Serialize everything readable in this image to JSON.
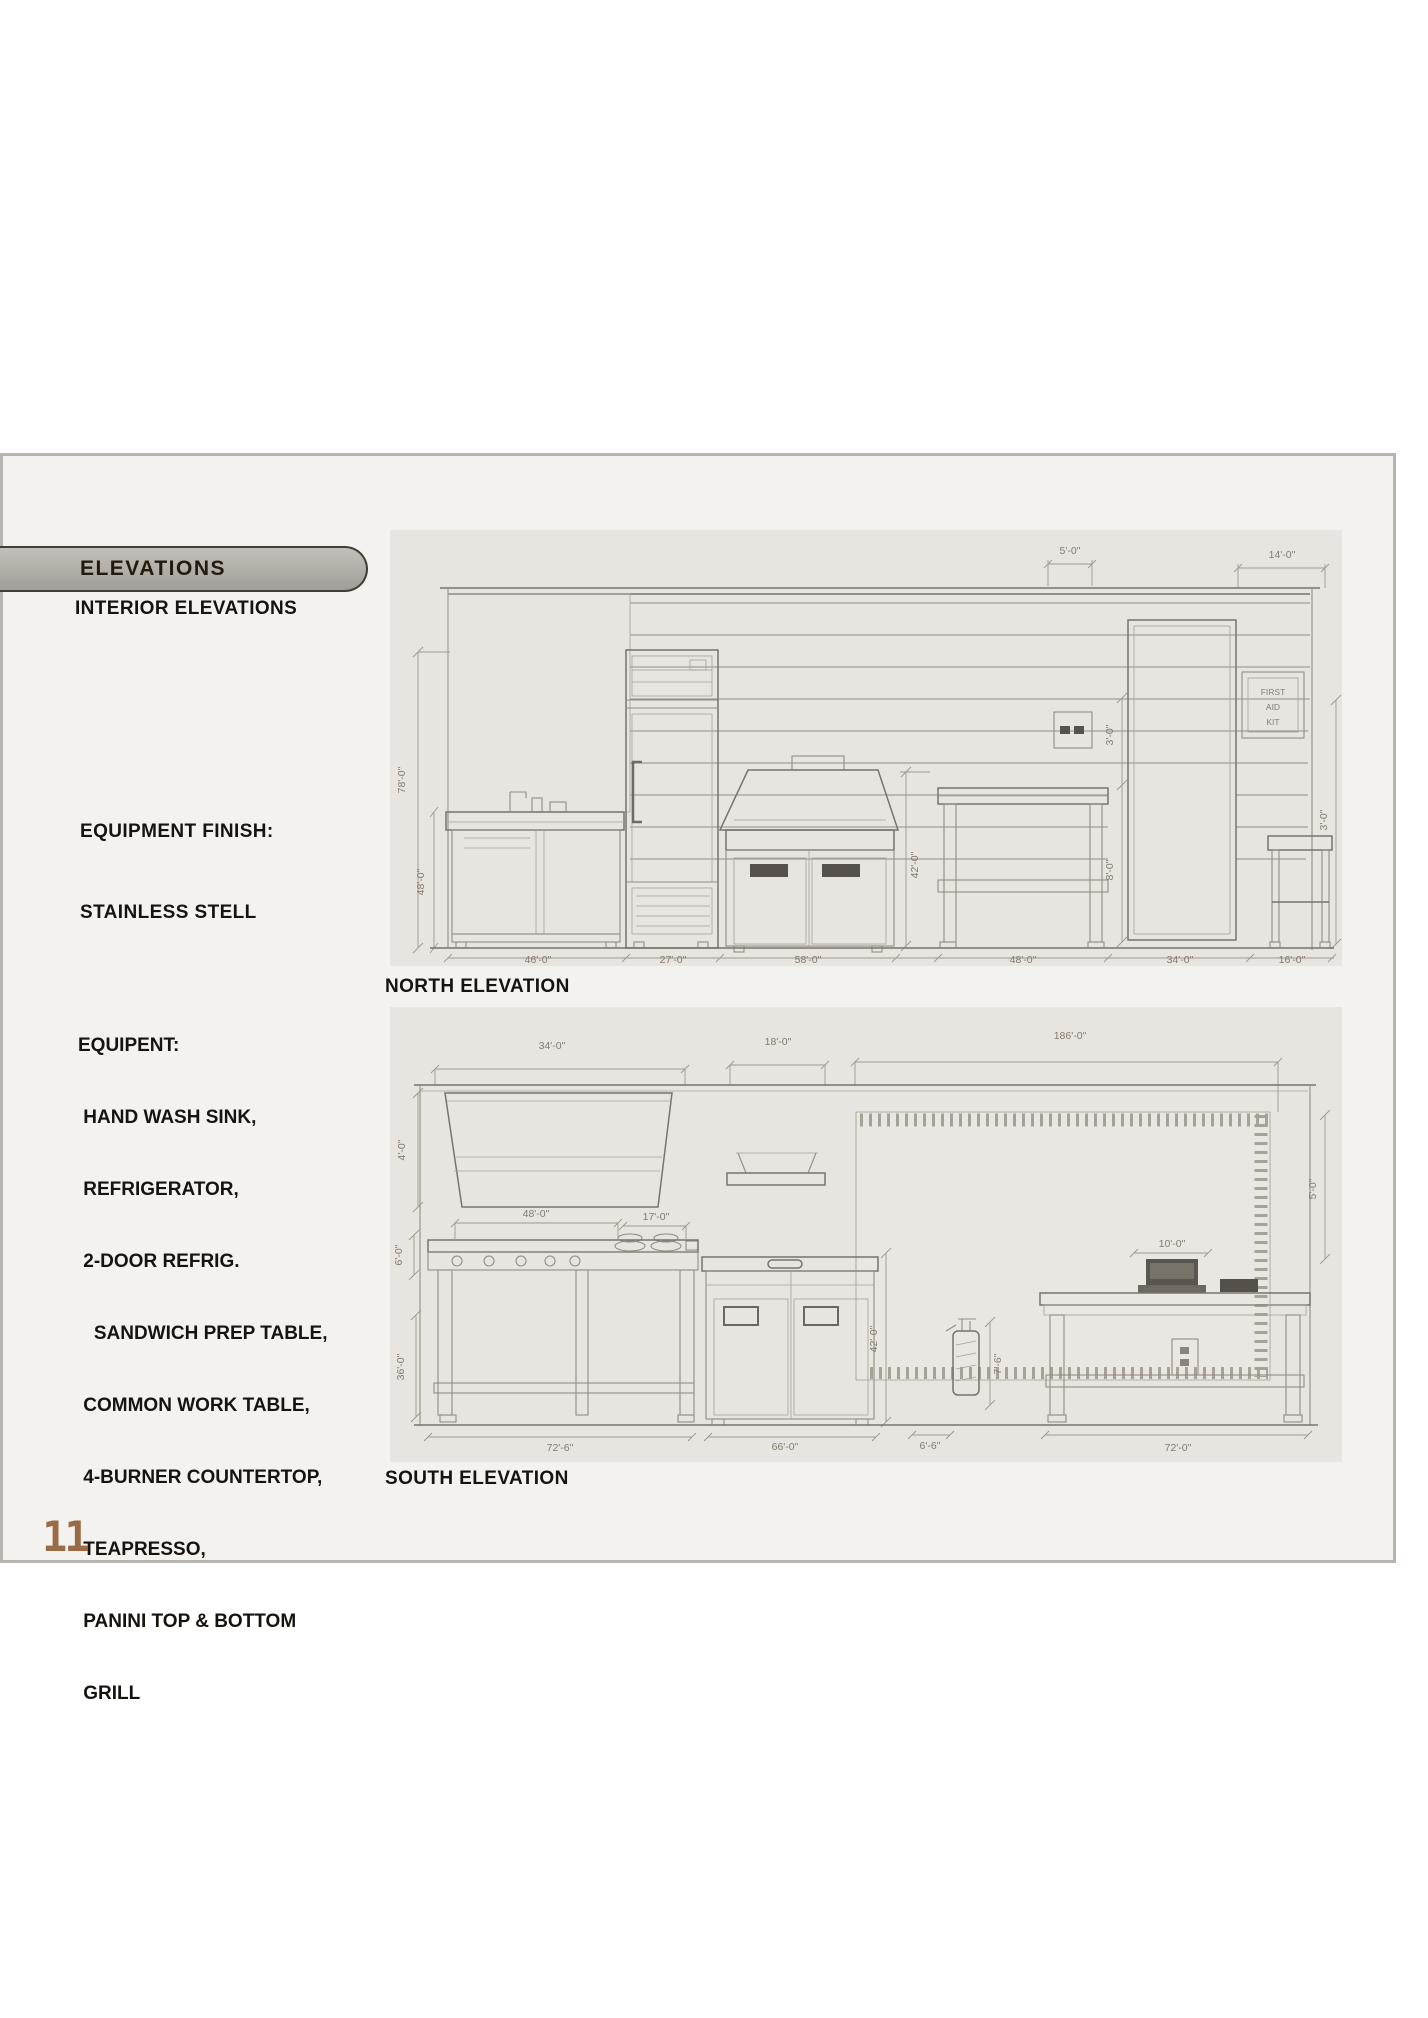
{
  "sidebar": {
    "tab": "ELEVATIONS",
    "subtitle": "INTERIOR ELEVATIONS",
    "finish_line1": "EQUIPMENT FINISH:",
    "finish_line2": "STAINLESS STELL",
    "equip_heading": "EQUIPENT:",
    "equip_items": [
      " HAND WASH SINK,",
      " REFRIGERATOR,",
      " 2-DOOR REFRIG.",
      "   SANDWICH PREP TABLE,",
      " COMMON WORK TABLE,",
      " 4-BURNER COUNTERTOP,",
      " TEAPRESSO,",
      " PANINI TOP & BOTTOM",
      " GRILL"
    ]
  },
  "north": {
    "label": "NORTH ELEVATION",
    "sign": [
      "FIRST",
      "AID",
      "KIT"
    ],
    "dims": {
      "top1": "5'-0\"",
      "top2": "14'-0\"",
      "left1": "78'-0\"",
      "left2": "48'-0\"",
      "mid1": "42'-0\"",
      "mid2": "3'-0\"",
      "mid3": "8'-0\"",
      "right1": "3'-0\"",
      "bottom": [
        "46'-0\"",
        "27'-0\"",
        "58'-0\"",
        "48'-0\"",
        "34'-0\"",
        "16'-0\""
      ]
    }
  },
  "south": {
    "label": "SOUTH ELEVATION",
    "dims": {
      "top1": "34'-0\"",
      "top2": "18'-0\"",
      "top3": "186'-0\"",
      "left1": "4'-0\"",
      "left2": "6'-0\"",
      "left3": "36'-0\"",
      "counter1": "48'-0\"",
      "counter2": "17'-0\"",
      "register": "10'-0\"",
      "mid1": "42'-0\"",
      "mid2": "7'-6\"",
      "right1": "5'-0\"",
      "bottom": [
        "72'-6\"",
        "66'-0\"",
        "6'-6\"",
        "72'-0\""
      ]
    }
  },
  "page_number": "11",
  "colors": {
    "accent_brown": "#9a6b47",
    "tab_bg": "#a9a59e",
    "paper": "#e8e5e1",
    "panel_bg": "#f4f2ef",
    "sketch_line": "#938c81"
  }
}
